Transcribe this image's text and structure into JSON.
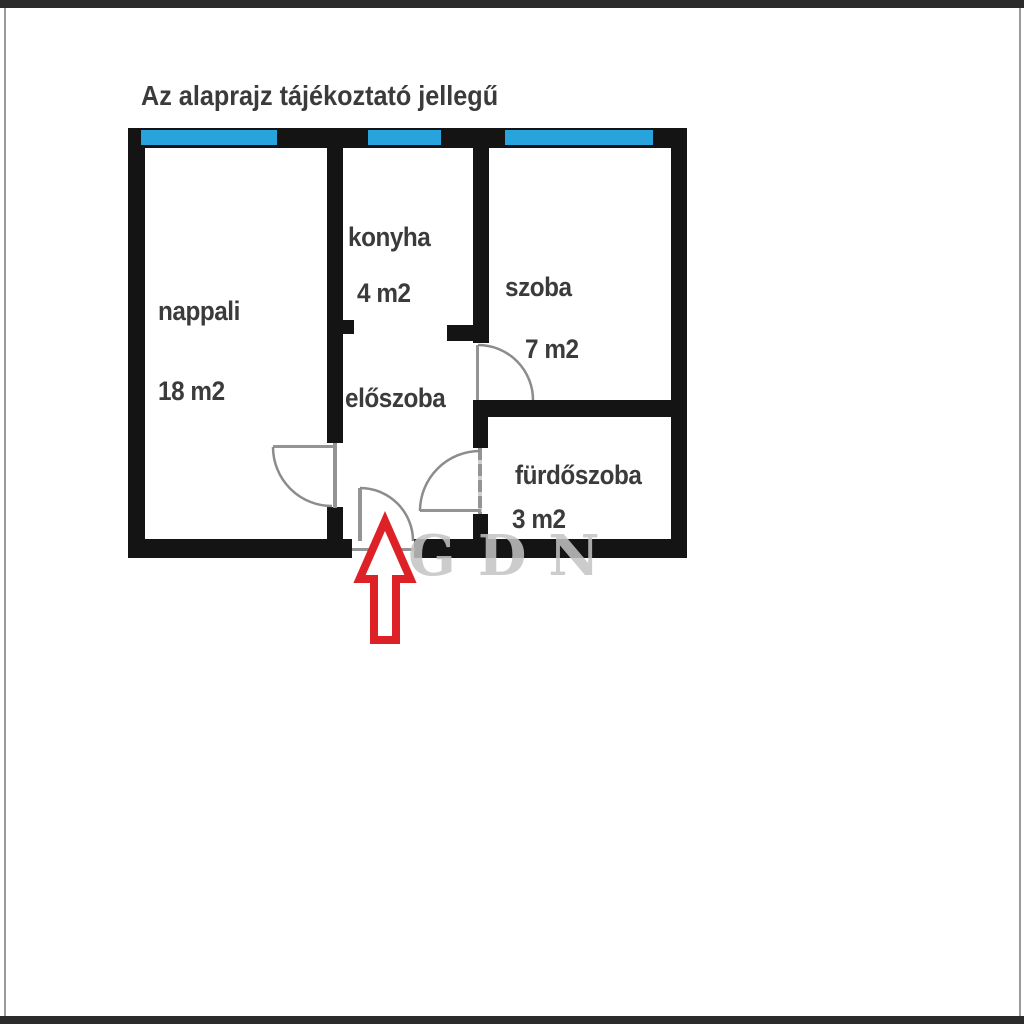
{
  "title": "Az alaprajz tájékoztató jellegű",
  "watermark": "GDN",
  "rooms": [
    {
      "name": "nappali",
      "area": "18 m2"
    },
    {
      "name": "konyha",
      "area": "4 m2"
    },
    {
      "name": "szoba",
      "area": "7 m2"
    },
    {
      "name": "előszoba",
      "area": ""
    },
    {
      "name": "fürdőszoba",
      "area": "3 m2"
    }
  ],
  "colors": {
    "wall": "#141414",
    "window": "#29a3dc",
    "door_line": "#949494",
    "door_arc": "#8c8c8c",
    "entrance_arrow": "#dd2127",
    "label_text": "#3b3b3c",
    "frame_bar": "#2b2b2b",
    "frame_edge": "#9a9a9a",
    "watermark": "#c4c4c4"
  },
  "icons": {
    "entrance_arrow": "up-arrow"
  }
}
